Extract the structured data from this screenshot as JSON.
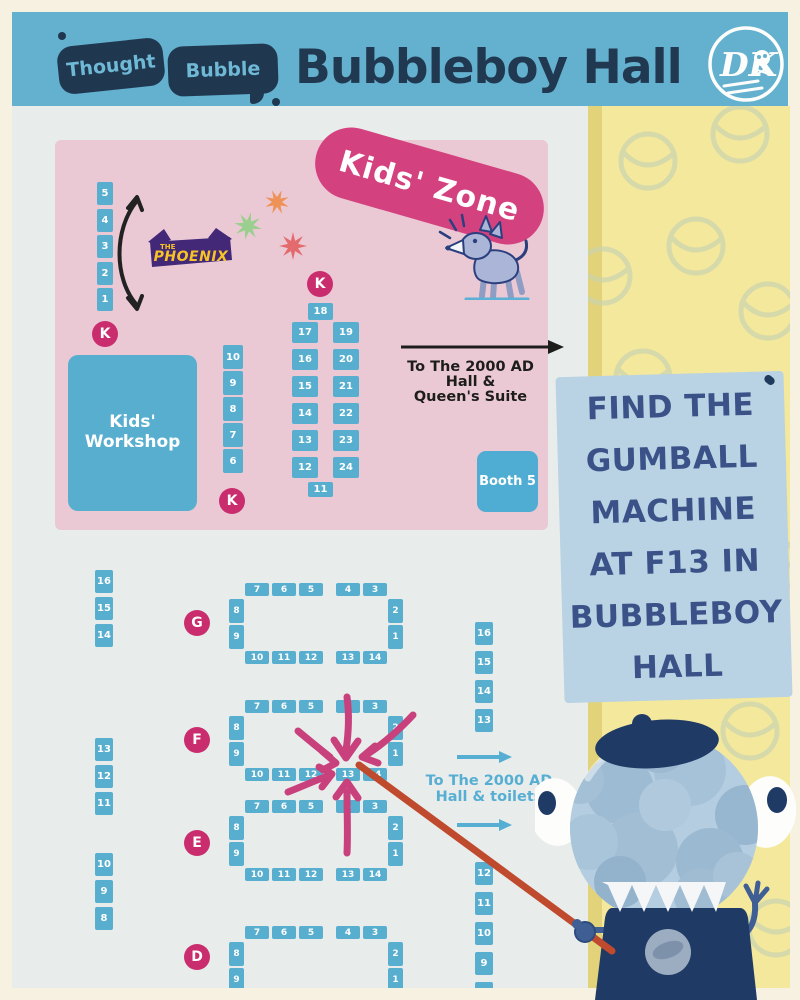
{
  "header": {
    "logo_word1": "Thought",
    "logo_word2": "Bubble",
    "title": "Bubbleboy Hall",
    "dk_monogram": "DK"
  },
  "kids_zone": {
    "pill_label": "Kids' Zone",
    "k_badge": "K",
    "phoenix": {
      "the": "THE",
      "name": "PHOENIX"
    },
    "left_column": [
      "5",
      "4",
      "3",
      "2",
      "1"
    ],
    "mid_column": [
      "10",
      "9",
      "8",
      "7",
      "6"
    ],
    "workshop": {
      "line1": "Kids'",
      "line2": "Workshop"
    },
    "island": {
      "top": "18",
      "left": [
        "17",
        "16",
        "15",
        "14",
        "13",
        "12"
      ],
      "right": [
        "19",
        "20",
        "21",
        "22",
        "23",
        "24"
      ],
      "bottom": "11"
    },
    "exit": {
      "line1": "To The 2000 AD",
      "line2": "Hall &",
      "line3": "Queen's Suite"
    },
    "booth5_label": "Booth 5"
  },
  "floor": {
    "left_wall": {
      "group1": [
        "16",
        "15",
        "14"
      ],
      "group2": [
        "13",
        "12",
        "11"
      ],
      "group3": [
        "10",
        "9",
        "8"
      ]
    },
    "right_wall": {
      "top": [
        "16",
        "15",
        "14",
        "13"
      ],
      "bottom": [
        "12",
        "11",
        "10",
        "9",
        "8"
      ]
    },
    "exit": {
      "line1": "To The 2000 AD",
      "line2": "Hall & toilets"
    },
    "rows": [
      {
        "letter": "G",
        "top_left": [
          "7",
          "6",
          "5"
        ],
        "top_right": [
          "4",
          "3"
        ],
        "left": [
          "8",
          "9"
        ],
        "right": [
          "2",
          "1"
        ],
        "bottom_left": [
          "10",
          "11",
          "12"
        ],
        "bottom_right": [
          "13",
          "14"
        ]
      },
      {
        "letter": "F",
        "top_left": [
          "7",
          "6",
          "5"
        ],
        "top_right": [
          "4",
          "3"
        ],
        "left": [
          "8",
          "9"
        ],
        "right": [
          "2",
          "1"
        ],
        "bottom_left": [
          "10",
          "11",
          "12"
        ],
        "bottom_right": [
          "13",
          "14"
        ]
      },
      {
        "letter": "E",
        "top_left": [
          "7",
          "6",
          "5"
        ],
        "top_right": [
          "4",
          "3"
        ],
        "left": [
          "8",
          "9"
        ],
        "right": [
          "2",
          "1"
        ],
        "bottom_left": [
          "10",
          "11",
          "12"
        ],
        "bottom_right": [
          "13",
          "14"
        ]
      },
      {
        "letter": "D",
        "top_left": [
          "7",
          "6",
          "5"
        ],
        "top_right": [
          "4",
          "3"
        ],
        "left": [
          "8",
          "9"
        ],
        "right": [
          "2",
          "1"
        ],
        "bottom_left": [],
        "bottom_right": []
      }
    ]
  },
  "sign": {
    "lines": [
      "FIND THE",
      "GUMBALL",
      "MACHINE",
      "AT F13 IN",
      "BUBBLEBOY",
      "HALL"
    ]
  },
  "colors": {
    "header_blue": "#63b0cf",
    "navy": "#203950",
    "booth_blue": "#58aecf",
    "magenta": "#c92d6e",
    "pink_zone": "#eac9d5",
    "yellow_panel": "#f3e89c",
    "sign_blue": "#b9d2e4",
    "sign_text": "#3a5287",
    "pointer_red": "#bf4a2e",
    "teal_text": "#57aed3",
    "floor_grey": "#e8edeb",
    "cream": "#f6f1e0",
    "phoenix_purple": "#432878",
    "phoenix_yellow": "#f7c325"
  }
}
